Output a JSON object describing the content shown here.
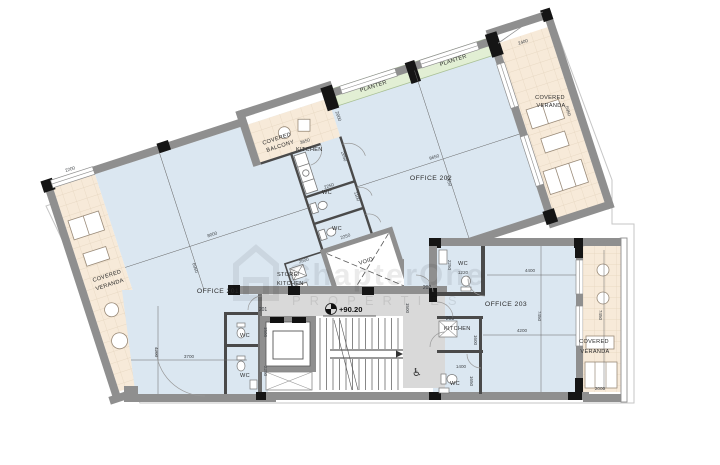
{
  "watermark": {
    "brand": "ChapterOne",
    "sub": "PROPERTIES"
  },
  "labels": {
    "office201": "OFFICE 201",
    "office202": "OFFICE 202",
    "office203": "OFFICE 203",
    "kitchen": "KITCHEN",
    "wc": "WC",
    "void": "VOID",
    "store1": "STORE/",
    "store2": "KITCHEN",
    "covered": "COVERED",
    "veranda": "VERANDA",
    "balcony": "BALCONY",
    "planter": "PLANTER",
    "level": "+90.20",
    "door201": "201",
    "door202": "202",
    "door203": "203"
  },
  "dims": {
    "win_left": "2200",
    "o201_w": "8000",
    "o201_d": "6950",
    "o202_w": "9650",
    "o202_d": "6950",
    "balcony_w": "3650",
    "balcony_d": "2000",
    "ver_tr_w": "2400",
    "ver_tr_l": "5950",
    "kitchen_d": "2050",
    "kitchen_w": "2250",
    "wc1_d": "1100",
    "wc2_d": "2250",
    "store_w": "2600",
    "o201_b_w": "3700",
    "o201_b_d": "4200",
    "o201_wc1": "1500",
    "o201_wc2": "2250",
    "corridor": "1500",
    "o203_a": "4400",
    "o203_b": "4200",
    "o203_d": "7450",
    "o203_wc_w": "2250",
    "o203_wc_b": "1220",
    "o203_k": "1600",
    "o203_wc2_w": "1400",
    "o203_wc2_d": "1650",
    "ver_r_l": "7450",
    "ver_r_w": "2000"
  }
}
